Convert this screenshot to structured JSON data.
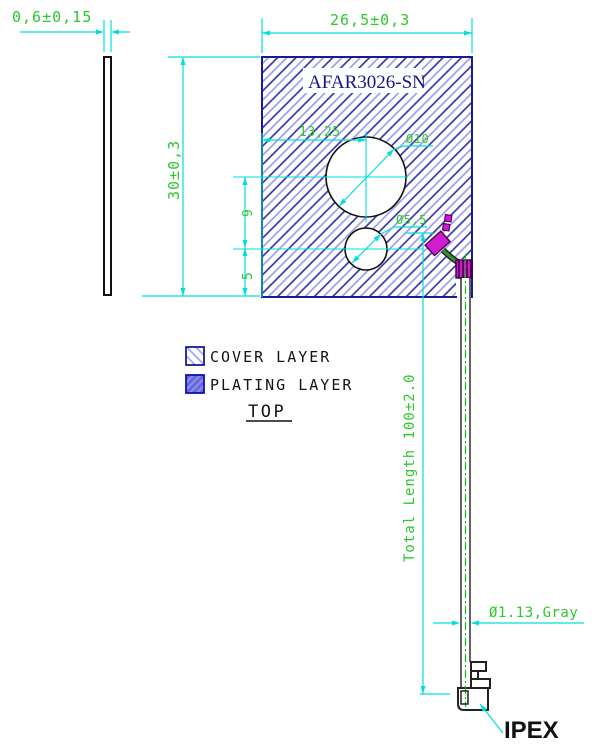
{
  "drawing": {
    "part_number": "AFAR3026-SN",
    "dimensions": {
      "thickness": "0,6±0,15",
      "width": "26,5±0,3",
      "height": "30±0,3",
      "hole_offset": "13,25",
      "hole_large_dia": "Ø10",
      "hole_small_dia": "Ø5,5",
      "hole_spacing": "9",
      "bottom_spacing": "5",
      "total_length": "Total Length 100±2.0",
      "cable_spec": "Ø1.13,Gray"
    },
    "legend": {
      "cover_label": "COVER LAYER",
      "plating_label": "PLATING LAYER"
    },
    "view_label": "TOP",
    "connector_label": "IPEX",
    "colors": {
      "dimension_text": "#2bc92b",
      "dimension_line": "#00dede",
      "plate_outline": "#1a1a96",
      "hatch_dark": "#2a2aa8",
      "hatch_light": "#9898e8",
      "plating_magenta": "#cf1ecf",
      "cable_green": "#2d6b2d"
    }
  }
}
